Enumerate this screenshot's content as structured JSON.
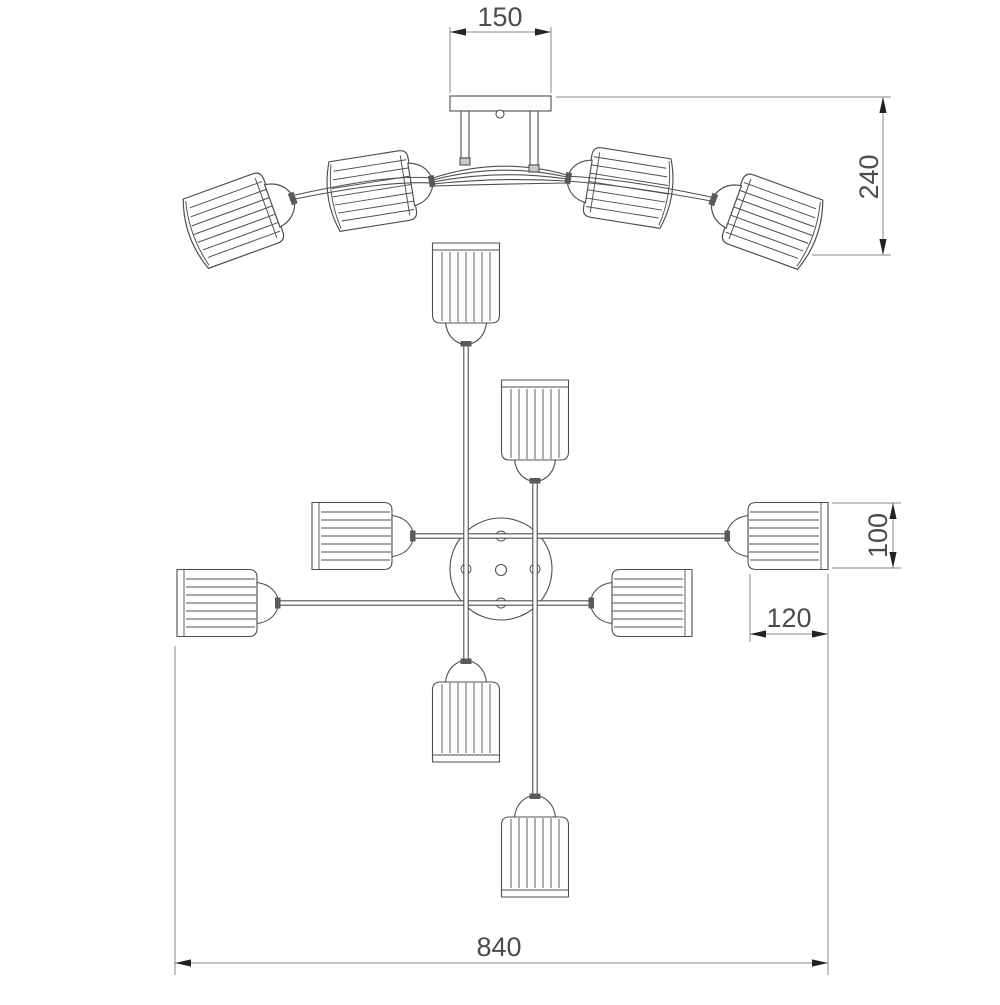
{
  "drawing": {
    "type": "technical dimension drawing",
    "views": {
      "top": "front elevation",
      "bottom": "plan view"
    }
  },
  "dimensions": {
    "canopy_plate_width": {
      "value": 150,
      "label": "150"
    },
    "overall_height": {
      "value": 240,
      "label": "240"
    },
    "shade_diameter": {
      "value": 100,
      "label": "100"
    },
    "shade_length": {
      "value": 120,
      "label": "120"
    },
    "overall_width": {
      "value": 840,
      "label": "840"
    }
  },
  "colors": {
    "line": "#4f4f4f",
    "dim": "#8a8a8a",
    "arrow": "#222222",
    "text": "#4c4c4c",
    "connector": "#5a5a5a",
    "cap_fill": "#c9c9c9",
    "background": "#ffffff"
  }
}
